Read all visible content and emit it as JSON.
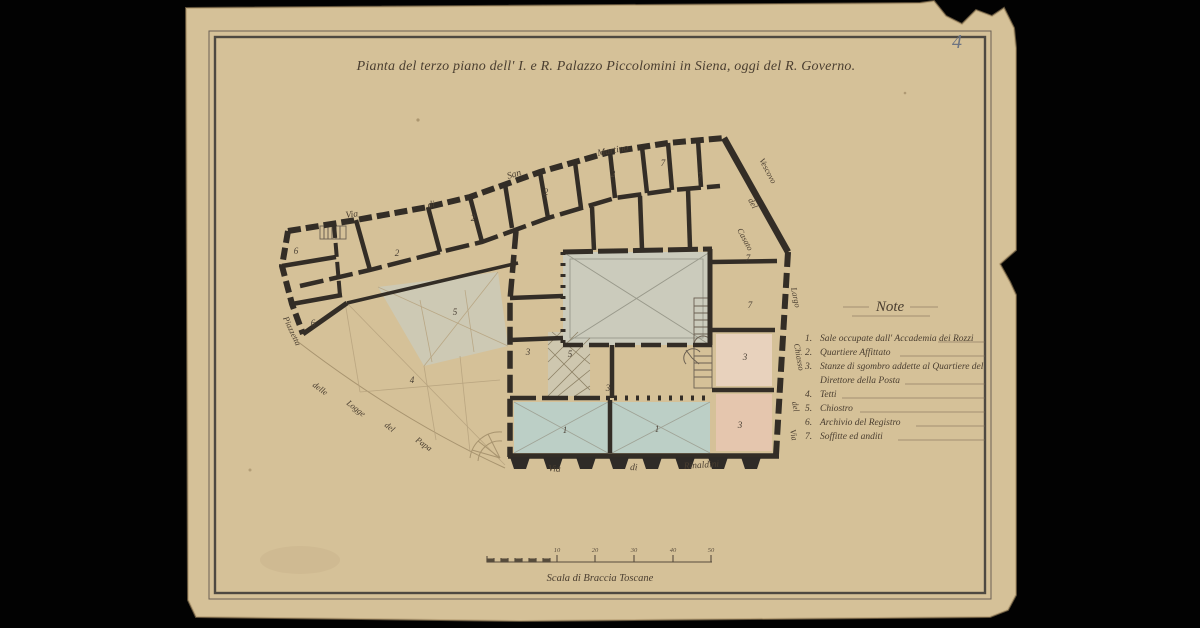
{
  "document": {
    "title": "Pianta del terzo piano dell' I. e R. Palazzo Piccolomini in Siena, oggi del R. Governo.",
    "page_number": "4"
  },
  "legend": {
    "heading": "Note",
    "items": [
      {
        "num": "1.",
        "text": "Sale occupate dall' Accademia dei Rozzi"
      },
      {
        "num": "2.",
        "text": "Quartiere Affittato"
      },
      {
        "num": "3.",
        "text": "Stanze di sgombro addette al Quartiere del",
        "text2": "Direttore della Posta"
      },
      {
        "num": "4.",
        "text": "Tetti"
      },
      {
        "num": "5.",
        "text": "Chiostro"
      },
      {
        "num": "6.",
        "text": "Archivio del Registro"
      },
      {
        "num": "7.",
        "text": "Soffitte ed anditi"
      }
    ]
  },
  "streets": {
    "top": [
      "Via",
      "di",
      "San",
      "Martino"
    ],
    "bottom": [
      "Via",
      "di",
      "Rinaldini"
    ],
    "left_upper": "Piazzetta",
    "left_lower": [
      "delle",
      "Logge",
      "del",
      "Papa"
    ],
    "right_upper": [
      "Casato",
      "del",
      "Vescovo"
    ],
    "right_side": [
      "Largo",
      "Chiasso",
      "del",
      "Via"
    ]
  },
  "plan": {
    "room_numbers": [
      "2",
      "2",
      "2",
      "2",
      "7",
      "7",
      "7",
      "7",
      "6",
      "6",
      "4",
      "5",
      "5",
      "3",
      "3",
      "3",
      "3",
      "1",
      "1"
    ]
  },
  "scale_bar": {
    "label": "Scala di Braccia Toscane",
    "ticks": [
      "10",
      "20",
      "30",
      "40",
      "50"
    ]
  },
  "colors": {
    "paper": "#d5c198",
    "ink": "#332d26",
    "wash_blue": "#bccfc6",
    "wash_pink": "#e5c6ae",
    "wash_gray": "#cbcbbc",
    "handwriting": "#4a3e30"
  }
}
